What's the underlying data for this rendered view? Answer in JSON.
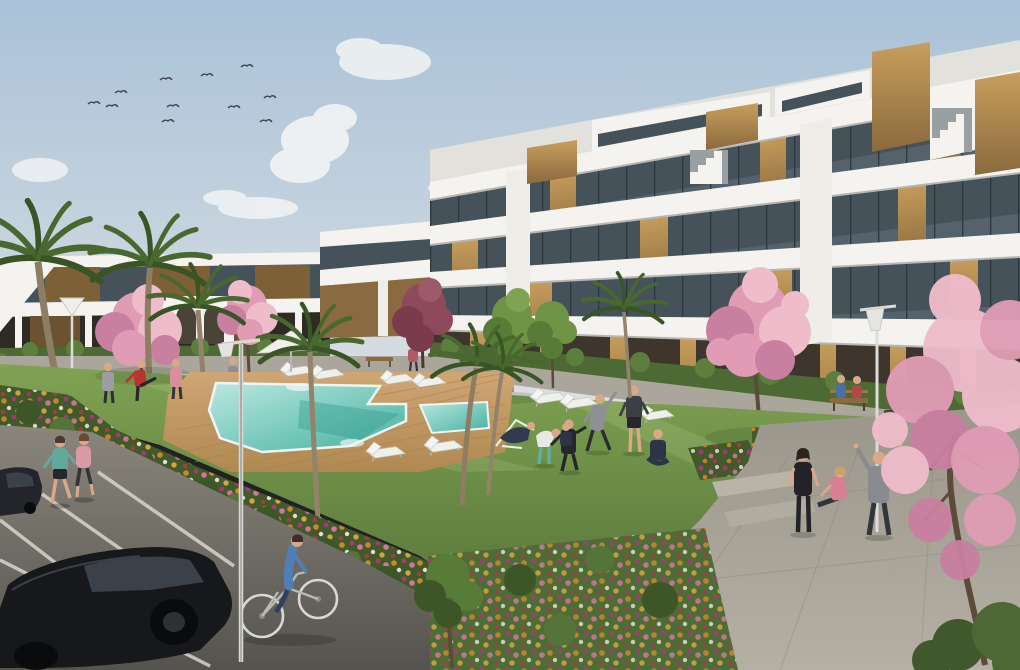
{
  "scene": {
    "type": "architectural-rendering",
    "description": "Modern white apartment complex with courtyard swimming pool, lawns, blossom and palm trees, flower beds, walkways, parking with cars and people exercising, jogging and cycling",
    "time_of_day": "late-afternoon-sun",
    "counts": {
      "birds": 11,
      "clouds": 6,
      "street_lamps": 3,
      "benches": 4,
      "sun_loungers": 9,
      "parasols": 1,
      "cars": 2,
      "pools": 2,
      "palm_trees": 6,
      "blossom_trees": 5,
      "green_trees": 3,
      "people": 20
    }
  },
  "palette": {
    "skyTop": "#a9c2d8",
    "skyHorizon": "#dde0e3",
    "cloud": "#f2f4f5",
    "buildingWhite": "#f4f3ef",
    "buildingShade": "#e3e1db",
    "bandShadow": "#b7b6b2",
    "glass": "#45525a",
    "glassLight": "#8fa3ad",
    "windowFrame": "#2c363c",
    "wood": "#c79e5c",
    "woodDark": "#8a6a3e",
    "woodSlat": "#7d6036",
    "pylonWhite": "#efede8",
    "groundFloorDark": "#3e362c",
    "hedge": "#4d6a34",
    "hedgeLight": "#5d7f3d",
    "lawnTop": "#7fa352",
    "lawnBottom": "#4f6c36",
    "lawnStripe": "#e9f5c4",
    "deckLight": "#cfa674",
    "deckDark": "#b08851",
    "plank": "#a87f4e",
    "poolEdge": "#eef6f3",
    "poolShallow": "#b9e8e0",
    "poolDeep": "#45b0a0",
    "poolShadow": "#2f9b8d",
    "backWalk": "#aaa69b",
    "pathTop": "#9a968b",
    "pathBottom": "#b4b0a4",
    "roadTop": "#8a867c",
    "roadBottom": "#55534e",
    "parkingLine": "#d8d5cc",
    "bedBase": "#42592a",
    "bushDark": "#3d5628",
    "bushLight": "#55743a",
    "flowerOrange": "#d2892e",
    "flowerGold": "#d9a942",
    "flowerPink": "#d678a2",
    "flowerMagenta": "#ab3780",
    "flowerRed": "#a53c48",
    "flowerWhite": "#e9e5d9",
    "blossomLight": "#eebccb",
    "blossomMid": "#df9cb4",
    "blossomDeep": "#c97f9f",
    "blossomDark": "#8e4a5a",
    "palmFrond": "#49682f",
    "palmFrondDark": "#395425",
    "treeGreen": "#6f9446",
    "treeGreenDark": "#567c38",
    "trunk": "#8d7d62",
    "trunkDark": "#5d4a3a",
    "carBody": "#17181b",
    "carGlass": "#3a4148",
    "wheel": "#0a0b0c",
    "lampMetal": "#dcdcd8",
    "skin": "#d8a888",
    "white": "#ffffff"
  },
  "people": [
    {
      "name": "jogger-teal",
      "activity": "jogging",
      "top": "#63a89b",
      "bottom": "#26262c"
    },
    {
      "name": "jogger-pink",
      "activity": "jogging",
      "top": "#d89aa5",
      "bottom": "#33343a"
    },
    {
      "name": "cyclist",
      "activity": "cycling",
      "top": "#4f7fb5",
      "bottom": "#31405f"
    },
    {
      "name": "poolside-stander-grey",
      "activity": "standing",
      "top": "#9d9da3",
      "bottom": "#2c2c34"
    },
    {
      "name": "poolside-kicker-red",
      "activity": "leg-stretch",
      "top": "#b8342e",
      "bottom": "#26262c"
    },
    {
      "name": "poolside-woman-pink",
      "activity": "standing",
      "top": "#d88f9c",
      "bottom": "#33343a"
    },
    {
      "name": "walker-near-pool",
      "activity": "walking",
      "top": "#8e8e94",
      "bottom": "#2c2c34"
    },
    {
      "name": "walker-courtyard",
      "activity": "walking",
      "top": "#b05a66",
      "bottom": "#33343a"
    },
    {
      "name": "deckchair-rester",
      "activity": "reclining",
      "top": "#323a52",
      "bottom": "#323a52"
    },
    {
      "name": "stretcher-teal-leggings",
      "activity": "toe-touch-stretch",
      "top": "#e8e8e4",
      "bottom": "#5fae9e"
    },
    {
      "name": "exerciser-black-tracksuit",
      "activity": "exercising",
      "top": "#26262c",
      "bottom": "#26262c"
    },
    {
      "name": "stretcher-grey-man",
      "activity": "side-stretch",
      "top": "#8f9096",
      "bottom": "#2c2c34"
    },
    {
      "name": "man-dark-shorts",
      "activity": "standing",
      "top": "#3c3f46",
      "bottom": "#26262c"
    },
    {
      "name": "sitter-cross-legged",
      "activity": "sitting",
      "top": "#2e3448",
      "bottom": "#2e3448"
    },
    {
      "name": "kid-dark",
      "activity": "standing",
      "top": "#2e3448",
      "bottom": "#26262c"
    },
    {
      "name": "standing-woman-right",
      "activity": "standing",
      "top": "#222228",
      "bottom": "#222228"
    },
    {
      "name": "sitting-woman-pink",
      "activity": "floor-stretch",
      "top": "#d87f93",
      "bottom": "#33343a"
    },
    {
      "name": "arms-up-man",
      "activity": "overhead-stretch",
      "top": "#8a8b91",
      "bottom": "#33353c"
    },
    {
      "name": "bench-sitter-blue",
      "activity": "sitting",
      "top": "#4a6fa5",
      "bottom": "#2c2c34"
    },
    {
      "name": "bench-sitter-red",
      "activity": "sitting",
      "top": "#b04a4a",
      "bottom": "#2c2c34"
    }
  ],
  "buildings": {
    "right_block": {
      "floors": 4,
      "style": "white terraced balconies, tinted glass, vertical timber cladding, rooftop timber boxes"
    },
    "left_block": {
      "floors": 2,
      "style": "white bands with timber slat walls, arched garden wall"
    }
  },
  "amenities": [
    "swimming-pool",
    "kids-pool",
    "wood-deck",
    "sun-loungers",
    "parasol",
    "lawn",
    "flower-beds",
    "benches",
    "street-lamps",
    "parking",
    "walkways"
  ]
}
